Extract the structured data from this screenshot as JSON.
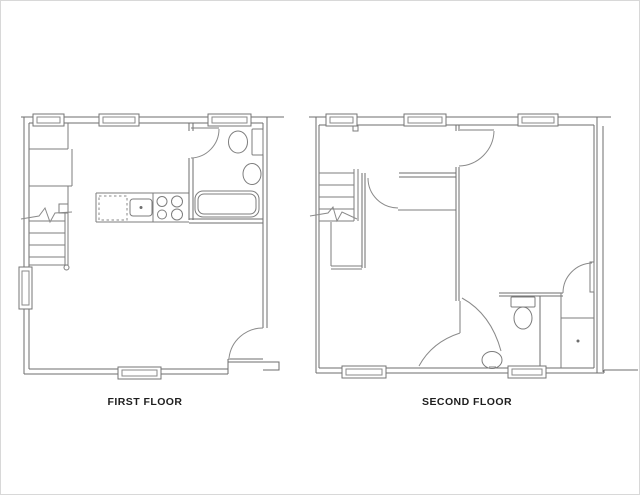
{
  "document": {
    "type": "architectural-floor-plan",
    "background": "#ffffff",
    "frame_color": "#d8d8d8"
  },
  "colors": {
    "line": "#7d7d7d",
    "wall": "#6e6e6e",
    "label_text": "#1e1e1e"
  },
  "floors": [
    {
      "label": "FIRST FLOOR",
      "fixtures": [
        "staircase",
        "dishwasher",
        "kitchen-sink",
        "stove",
        "bathtub",
        "toilet",
        "bathroom-sink"
      ],
      "window_count": 5,
      "door_count": 2
    },
    {
      "label": "SECOND FLOOR",
      "fixtures": [
        "staircase",
        "toilet",
        "bathroom-sink",
        "walk-in-closet"
      ],
      "window_count": 5,
      "door_count": 5
    }
  ]
}
